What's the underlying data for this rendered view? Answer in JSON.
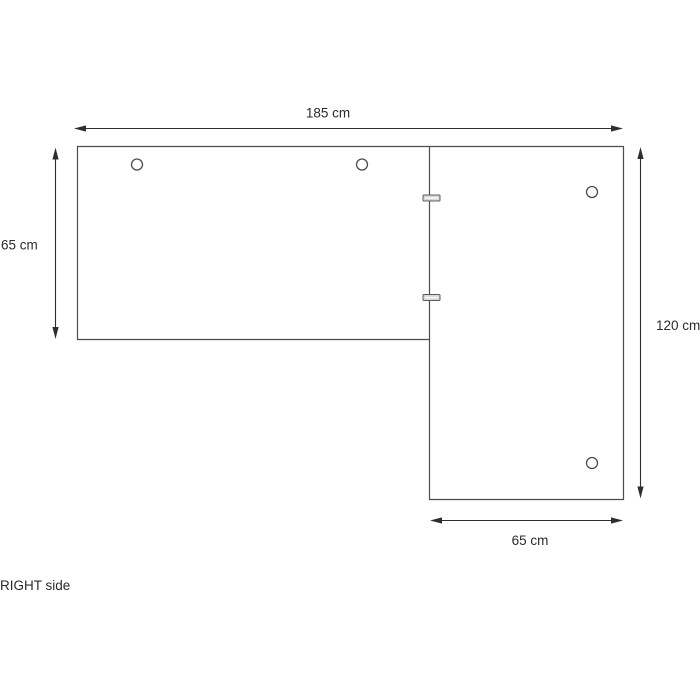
{
  "diagram": {
    "title": "RIGHT side",
    "dimensions": {
      "top_width": {
        "label": "185 cm",
        "value": 185,
        "unit": "cm"
      },
      "left_depth": {
        "label": "65 cm",
        "value": 65,
        "unit": "cm"
      },
      "right_length": {
        "label": "120 cm",
        "value": 120,
        "unit": "cm"
      },
      "bottom_depth": {
        "label": "65 cm",
        "value": 65,
        "unit": "cm"
      }
    },
    "features": {
      "mounting_holes": 4,
      "cam_connectors": 2
    },
    "colors": {
      "background": "#ffffff",
      "outline": "#4d4d4d",
      "dimension": "#2e2e2e",
      "text": "#2b2b2b",
      "tab_fill": "#d7d7d7",
      "tab_stroke": "#5c5c5c"
    }
  }
}
